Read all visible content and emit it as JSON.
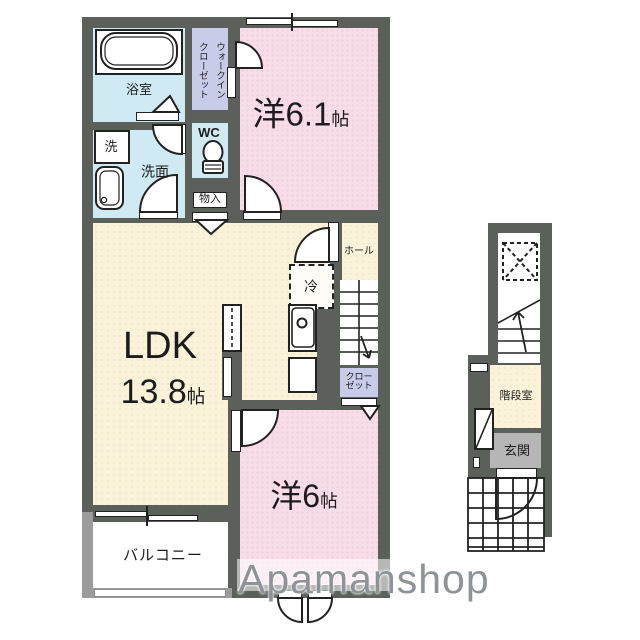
{
  "plan": {
    "rooms": {
      "bath": {
        "label": "浴室"
      },
      "wic": {
        "line1": "ウォークイン",
        "line2": "クローゼット"
      },
      "washer": {
        "label": "洗"
      },
      "washroom": {
        "label": "洗面"
      },
      "wc": {
        "label": "WC"
      },
      "storage": {
        "label": "物入"
      },
      "west61": {
        "name": "洋6.1",
        "unit": "帖"
      },
      "ldk": {
        "name": "LDK",
        "size": "13.8",
        "unit": "帖"
      },
      "hall": {
        "label": "ホール"
      },
      "fridge": {
        "label": "冷"
      },
      "closet": {
        "line1": "クロー",
        "line2": "ゼット"
      },
      "west6": {
        "name": "洋6",
        "unit": "帖"
      },
      "balcony": {
        "label": "バルコニー"
      },
      "stairhall": {
        "label": "階段室"
      },
      "entrance": {
        "label": "玄関"
      }
    },
    "watermark": {
      "text": "Apamanshop"
    },
    "icons": {
      "bathtub": "bathtub-icon",
      "toilet": "toilet-icon",
      "washbasin": "washbasin-icon",
      "kitchen_sink": "kitchen-sink-icon",
      "stairs": "stairs-icon",
      "door_swing": "door-swing-icon",
      "folding_door": "folding-door-icon",
      "window": "window-icon",
      "tile_grid": "entrance-tile-grid",
      "void": "void-x-icon",
      "shoe_cabinet": "shoe-cabinet-icon",
      "up_arrow": "stair-direction-arrow"
    },
    "colors": {
      "wall": "#5c605a",
      "water_rooms": "#cfeaf3",
      "closets": "#c9cce9",
      "bedrooms": "#f8dce8",
      "ldk": "#faf3da",
      "entrance_gray": "#b6b6b6",
      "balcony_wall": "#9c9c9c",
      "watermark": "#8e9398"
    }
  }
}
